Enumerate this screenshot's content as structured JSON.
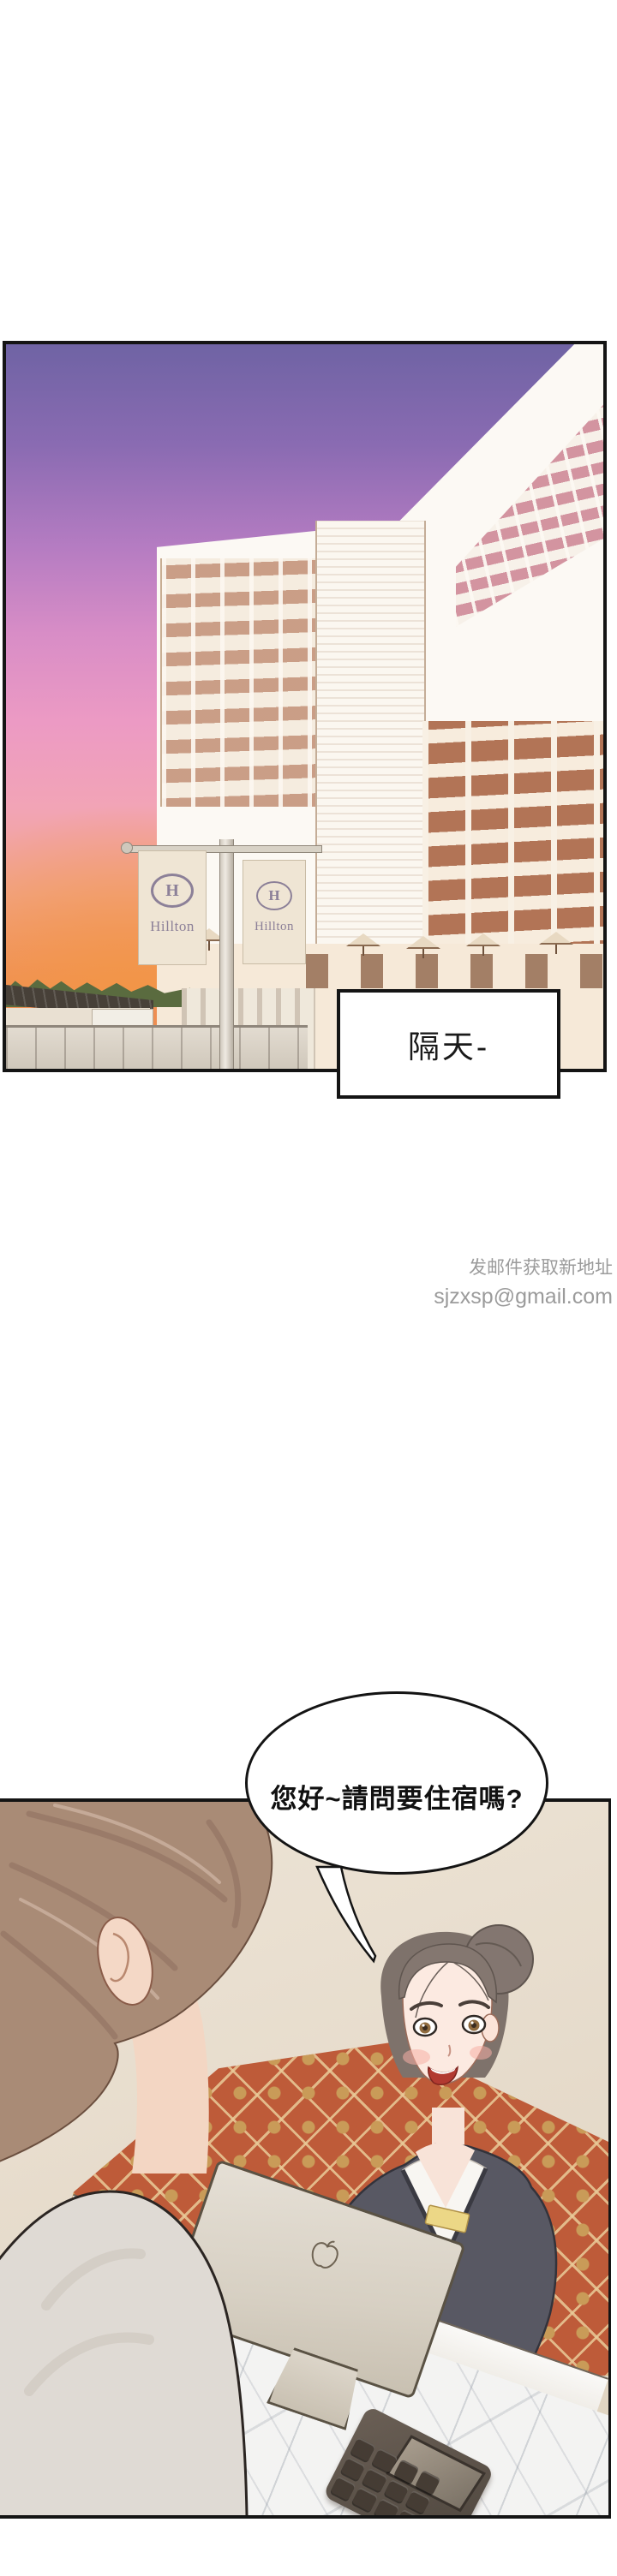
{
  "panel1": {
    "caption": {
      "text": "隔天-"
    },
    "hotel": {
      "banners": [
        {
          "logo": "H",
          "label": "Hillton"
        },
        {
          "logo": "H",
          "label": "Hillton"
        }
      ]
    },
    "colors": {
      "sky_top": "#6F63A4",
      "sky_pink": "#EC9AC4",
      "sky_orange": "#ED8C4B",
      "banner_bg": "#EFE5D4",
      "banner_text": "#8C8098"
    }
  },
  "watermark": {
    "line1": "发邮件获取新地址",
    "line2": "sjzxsp@gmail.com",
    "color": "#9B9B9B"
  },
  "panel2": {
    "speech": {
      "text": "您好~請問要住宿嗎?"
    },
    "icons": {
      "computer_logo": "apple-logo"
    },
    "colors": {
      "wall": "#E8DECF",
      "carpet": "#BE5B39",
      "marble": "#F3F3F2",
      "suit": "#585863",
      "name_tag": "#ECD786"
    }
  }
}
